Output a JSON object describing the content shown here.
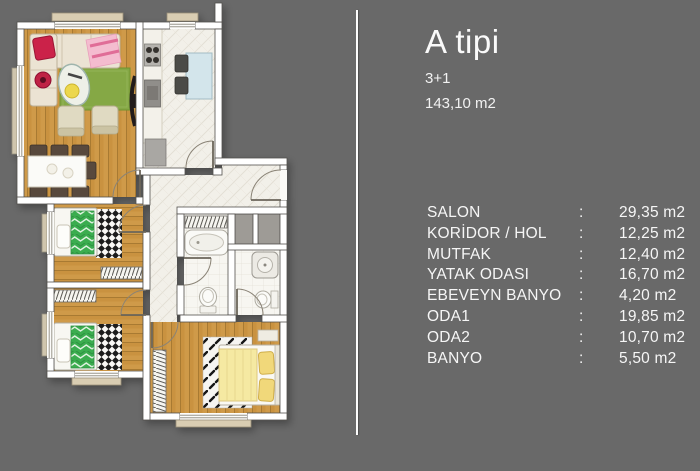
{
  "panel": {
    "title": "A tipi",
    "subtitle": "3+1",
    "total_area": "143,10 m2",
    "separator": ":",
    "rooms": [
      {
        "label": "SALON",
        "area": "29,35 m2"
      },
      {
        "label": "KORİDOR / HOL",
        "area": "12,25 m2"
      },
      {
        "label": "MUTFAK",
        "area": "12,40 m2"
      },
      {
        "label": "YATAK ODASI",
        "area": "16,70 m2"
      },
      {
        "label": "EBEVEYN BANYO",
        "area": "4,20 m2"
      },
      {
        "label": "ODA1",
        "area": "19,85 m2"
      },
      {
        "label": "ODA2",
        "area": "10,70 m2"
      },
      {
        "label": "BANYO",
        "area": "5,50 m2"
      }
    ]
  },
  "floorplan": {
    "kind": "furnished top-down apartment floor plan, no text labels",
    "colors": {
      "background": "#696969",
      "wall": "#ffffff",
      "wood_floor": "#c9923f",
      "tile_floor": "#f2f0e9",
      "rug_green": "#85a844",
      "bed_green": "#3bad4f",
      "bed_yellow": "#f5e9a2",
      "sofa_cream": "#ebe3d3",
      "pillow_red": "#cb2348",
      "kitchen_table_blue": "#d3e5eb"
    }
  },
  "colors": {
    "text": "#f5f5f5",
    "divider": "#fcfcfc"
  }
}
